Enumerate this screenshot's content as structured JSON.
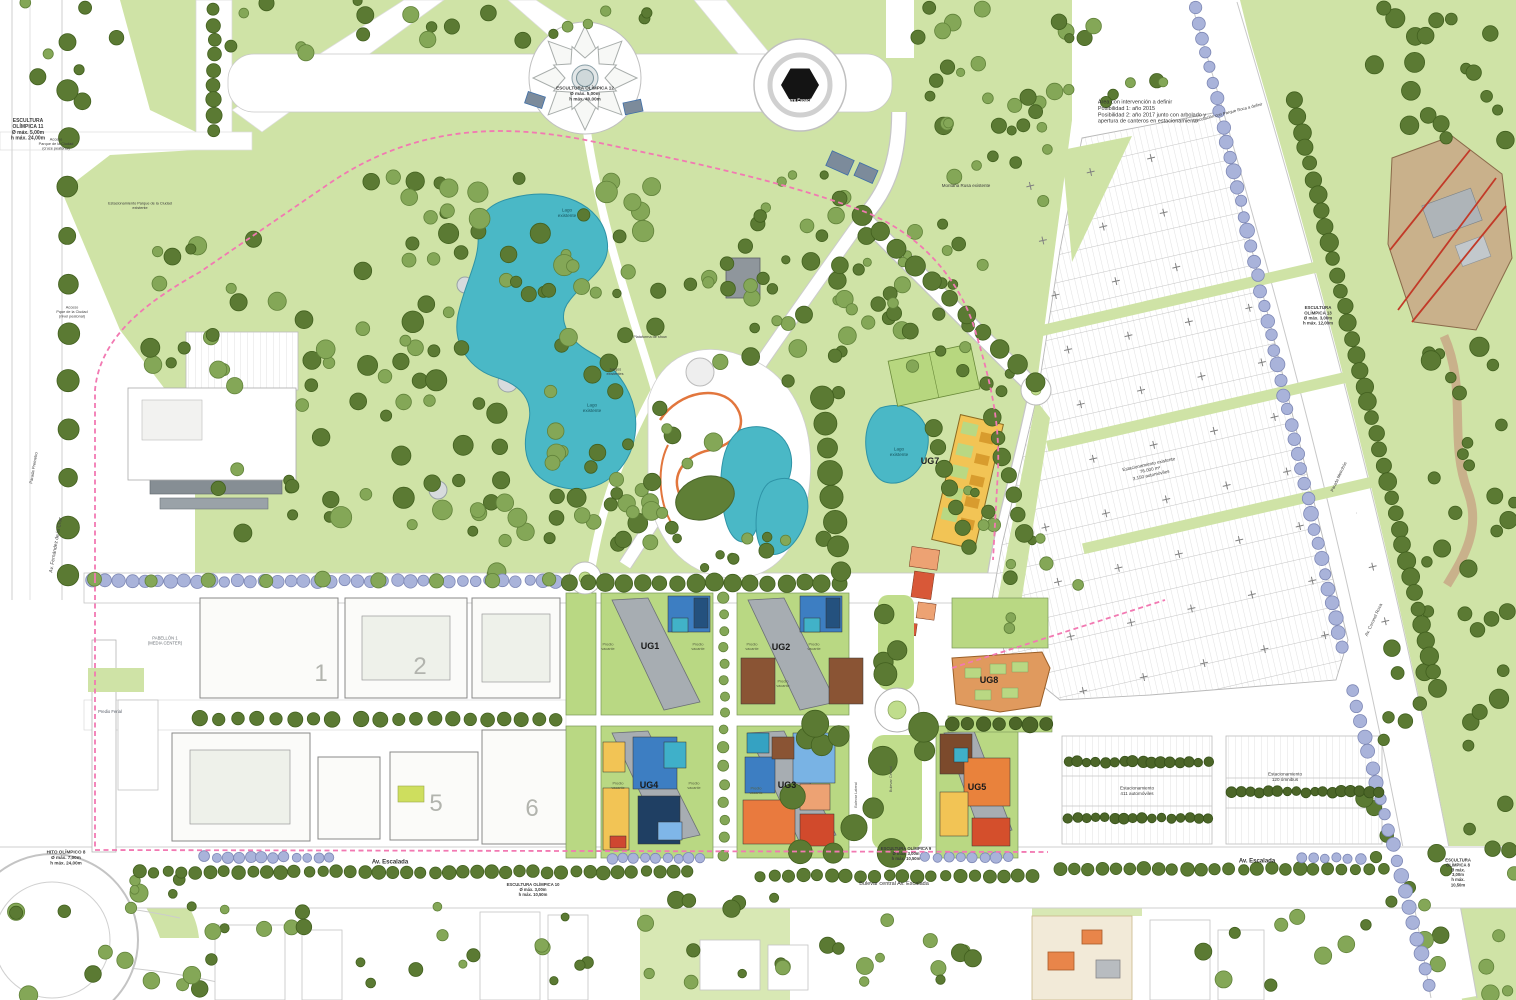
{
  "colors": {
    "park_green": "#cfe3a6",
    "plot_green": "#b9d883",
    "lake_teal": "#4ab8c6",
    "boundary_pink": "#f279b2",
    "tree_dark": "#5b7a33",
    "tree_blue": "#a9b3da",
    "building_yellow": "#f2c455",
    "building_blue": "#3d7ec2",
    "building_orange": "#e9823c",
    "building_brown": "#8a5434",
    "road_white": "#ffffff"
  },
  "labels": [
    {
      "t": "ESCULTURA\nOLÍMPICA 11\nØ máx. 5,00m\nh máx. 24,00m",
      "x": 28,
      "y": 130,
      "s": 5,
      "w": 700
    },
    {
      "t": "Acceso\nParque de la Ciudad\n(cruce peatonal)",
      "x": 56,
      "y": 144,
      "s": 3.8
    },
    {
      "t": "Estacionamiento Parque de la Ciudad\nexistente",
      "x": 140,
      "y": 206,
      "s": 3.8
    },
    {
      "t": "Acceso\nPque de la Ciudad\n(nivel peatonal)",
      "x": 72,
      "y": 312,
      "s": 3.8
    },
    {
      "t": "Área con intervención a definir\nPosibilidad 1: año 2015\nPosibilidad 2: año 2017 junto con arbolado y\napertura de canteros en estacionamiento",
      "x": 1152,
      "y": 112,
      "s": 5.5,
      "a": "left",
      "c": "#333333"
    },
    {
      "t": "Vinculación con Parque Roca a definir",
      "x": 1228,
      "y": 113,
      "s": 4.2,
      "r": -14
    },
    {
      "t": "Montaña Rusa existente",
      "x": 966,
      "y": 186,
      "s": 4.5
    },
    {
      "t": "ESCULTURA OLÍMPICA 12\nØ máx. 5,00m\nh máx. 40,00m",
      "x": 585,
      "y": 94,
      "s": 4.6,
      "w": 700
    },
    {
      "t": "Torre Espacial\nexistente",
      "x": 800,
      "y": 103,
      "s": 4.2,
      "w": 700,
      "c": "#ffffff"
    },
    {
      "t": "Lago\nexistente",
      "x": 567,
      "y": 213,
      "s": 4.6,
      "c": "#17555e"
    },
    {
      "t": "Lago\nexistente",
      "x": 592,
      "y": 408,
      "s": 4.6,
      "c": "#17555e"
    },
    {
      "t": "Lago\nexistente",
      "x": 899,
      "y": 452,
      "s": 4.6,
      "c": "#17555e"
    },
    {
      "t": "Plataforma de show",
      "x": 650,
      "y": 337,
      "s": 3.8
    },
    {
      "t": "Juegos\nexistentes",
      "x": 615,
      "y": 372,
      "s": 3.8
    },
    {
      "t": "UG7",
      "x": 930,
      "y": 462,
      "s": 9,
      "w": 700,
      "c": "#222222"
    },
    {
      "t": "UG1",
      "x": 650,
      "y": 647,
      "s": 9,
      "w": 700,
      "c": "#1a1a1a"
    },
    {
      "t": "UG2",
      "x": 781,
      "y": 648,
      "s": 9,
      "w": 700,
      "c": "#1a1a1a"
    },
    {
      "t": "UG4",
      "x": 649,
      "y": 786,
      "s": 9,
      "w": 700,
      "c": "#1a1a1a"
    },
    {
      "t": "UG3",
      "x": 787,
      "y": 786,
      "s": 9,
      "w": 700,
      "c": "#1a1a1a"
    },
    {
      "t": "UG5",
      "x": 977,
      "y": 788,
      "s": 9,
      "w": 700,
      "c": "#1a1a1a"
    },
    {
      "t": "UG8",
      "x": 989,
      "y": 681,
      "s": 9,
      "w": 700,
      "c": "#1a1a1a"
    },
    {
      "t": "Predio\nvacante",
      "x": 608,
      "y": 647,
      "s": 3.8,
      "c": "#55603f"
    },
    {
      "t": "Predio\nvacante",
      "x": 698,
      "y": 647,
      "s": 3.8,
      "c": "#55603f"
    },
    {
      "t": "Predio\nvacante",
      "x": 752,
      "y": 647,
      "s": 3.8,
      "c": "#55603f"
    },
    {
      "t": "Predio\nvacante",
      "x": 814,
      "y": 647,
      "s": 3.8,
      "c": "#55603f"
    },
    {
      "t": "Predio\nvacante",
      "x": 783,
      "y": 684,
      "s": 3.8,
      "c": "#55603f"
    },
    {
      "t": "Predio\nvacante",
      "x": 618,
      "y": 786,
      "s": 3.8,
      "c": "#55603f"
    },
    {
      "t": "Predio\nvacante",
      "x": 694,
      "y": 786,
      "s": 3.8,
      "c": "#55603f"
    },
    {
      "t": "Predio\nvacante",
      "x": 756,
      "y": 791,
      "s": 3.8,
      "c": "#55603f"
    },
    {
      "t": "PABELLÓN 1\n(MEDIA CENTER)",
      "x": 165,
      "y": 641,
      "s": 4.2,
      "c": "#6a6f75"
    },
    {
      "t": "1",
      "x": 321,
      "y": 676,
      "s": 24,
      "c": "#b2b4ae"
    },
    {
      "t": "2",
      "x": 420,
      "y": 669,
      "s": 24,
      "c": "#b2b4ae"
    },
    {
      "t": "5",
      "x": 436,
      "y": 806,
      "s": 24,
      "c": "#b2b4ae"
    },
    {
      "t": "6",
      "x": 532,
      "y": 811,
      "s": 24,
      "c": "#b2b4ae"
    },
    {
      "t": "Predio Ferial",
      "x": 110,
      "y": 712,
      "s": 4.2,
      "c": "#555b66"
    },
    {
      "t": "Parada Premetro",
      "x": 34,
      "y": 468,
      "s": 4.2,
      "r": -80
    },
    {
      "t": "Av. Fernández de la Cruz",
      "x": 56,
      "y": 545,
      "s": 5,
      "r": -80,
      "c": "#444444"
    },
    {
      "t": "Parada Metrobús",
      "x": 1339,
      "y": 477,
      "s": 4.2,
      "r": -65
    },
    {
      "t": "Av. Coronel Roca",
      "x": 1374,
      "y": 620,
      "s": 4.6,
      "r": -65,
      "c": "#444444"
    },
    {
      "t": "ESCULTURA\nOLÍMPICA 13\nØ máx. 3,00m\nh máx. 12,00m",
      "x": 1318,
      "y": 316,
      "s": 4.4,
      "w": 700
    },
    {
      "t": "Estacionamiento existente\n76.000 m²\n3.150 automóviles",
      "x": 1150,
      "y": 470,
      "s": 4.6,
      "r": -12
    },
    {
      "t": "Estacionamiento\n411 automóviles",
      "x": 1137,
      "y": 791,
      "s": 4.6
    },
    {
      "t": "Estacionamiento\n120 ómnibus",
      "x": 1285,
      "y": 777,
      "s": 4.6
    },
    {
      "t": "HITO OLÍMPICO 8\nØ máx. 7,00m\nh máx. 24,00m",
      "x": 66,
      "y": 858,
      "s": 4.6,
      "w": 700
    },
    {
      "t": "Av. Escalada",
      "x": 390,
      "y": 862,
      "s": 6,
      "w": 700,
      "c": "#333333"
    },
    {
      "t": "ESCULTURA OLÍMPICA 10\nØ máx. 3,00m\nh máx. 10,50m",
      "x": 533,
      "y": 890,
      "s": 4.2,
      "w": 700
    },
    {
      "t": "ESCULTURA OLÍMPICA 9\nØ máx. 3,00m\nh máx. 10,50m",
      "x": 906,
      "y": 854,
      "s": 4.2,
      "w": 700
    },
    {
      "t": "Bulevar central Av. Escalada",
      "x": 894,
      "y": 884,
      "s": 5.5,
      "c": "#333333"
    },
    {
      "t": "Av. Escalada",
      "x": 1257,
      "y": 861,
      "s": 6,
      "w": 700,
      "c": "#333333"
    },
    {
      "t": "ESCULTURA OLÍMPICA 8\nØ máx. 3,00m\nh máx. 10,50m",
      "x": 1458,
      "y": 873,
      "s": 4.2,
      "w": 700
    },
    {
      "t": "Bulevar Lateral",
      "x": 856,
      "y": 795,
      "s": 3.8,
      "r": -90,
      "c": "#555555"
    },
    {
      "t": "Bulevar Central",
      "x": 891,
      "y": 779,
      "s": 3.8,
      "r": -90,
      "c": "#555555"
    }
  ]
}
